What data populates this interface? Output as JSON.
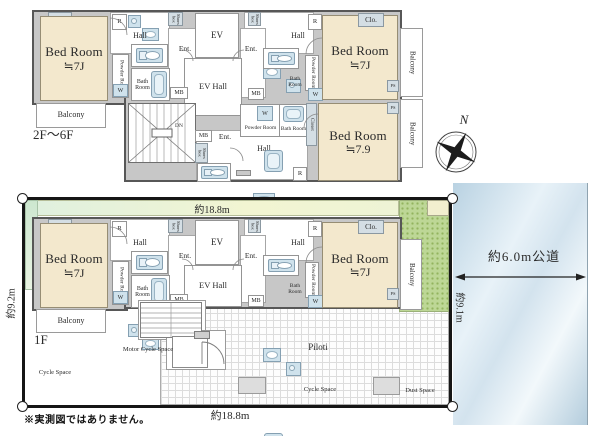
{
  "terms": {
    "bed_room": "Bed Room",
    "size_7j": "≒7J",
    "size_7_9": "≒7.9",
    "hall": "Hall",
    "ev": "EV",
    "ev_hall": "EV Hall",
    "ent": "Ent.",
    "balcony": "Balcony",
    "clo": "Clo.",
    "closet": "Closet",
    "powder_room": "Powder Room",
    "bath_room": "Bath Room",
    "shoes_box": "Shoes box",
    "mb": "MB",
    "ps": "PS",
    "w": "W",
    "r": "R",
    "dn": "DN",
    "piloti": "Piloti",
    "cycle_space": "Cycle Space",
    "motor_cycle_space": "Motor Cycle Space",
    "dust_space": "Dust Space"
  },
  "floor_labels": {
    "upper": "2F〜6F",
    "first": "1F"
  },
  "dimensions": {
    "width_top": "約18.8m",
    "width_bottom": "約18.8m",
    "depth_left": "約9.2m",
    "depth_right": "約9.1m",
    "road": "約6.0m公道"
  },
  "compass": {
    "north": "N"
  },
  "note": "※実測図ではありません。",
  "colors": {
    "bedroom_fill": "#f3e8cd",
    "wall_fill": "#c7c7c7",
    "fixture_fill": "#cfe2ec",
    "planting_green": "#bdd796",
    "road_blue": "#c9dbe7",
    "site_border": "#161616"
  }
}
